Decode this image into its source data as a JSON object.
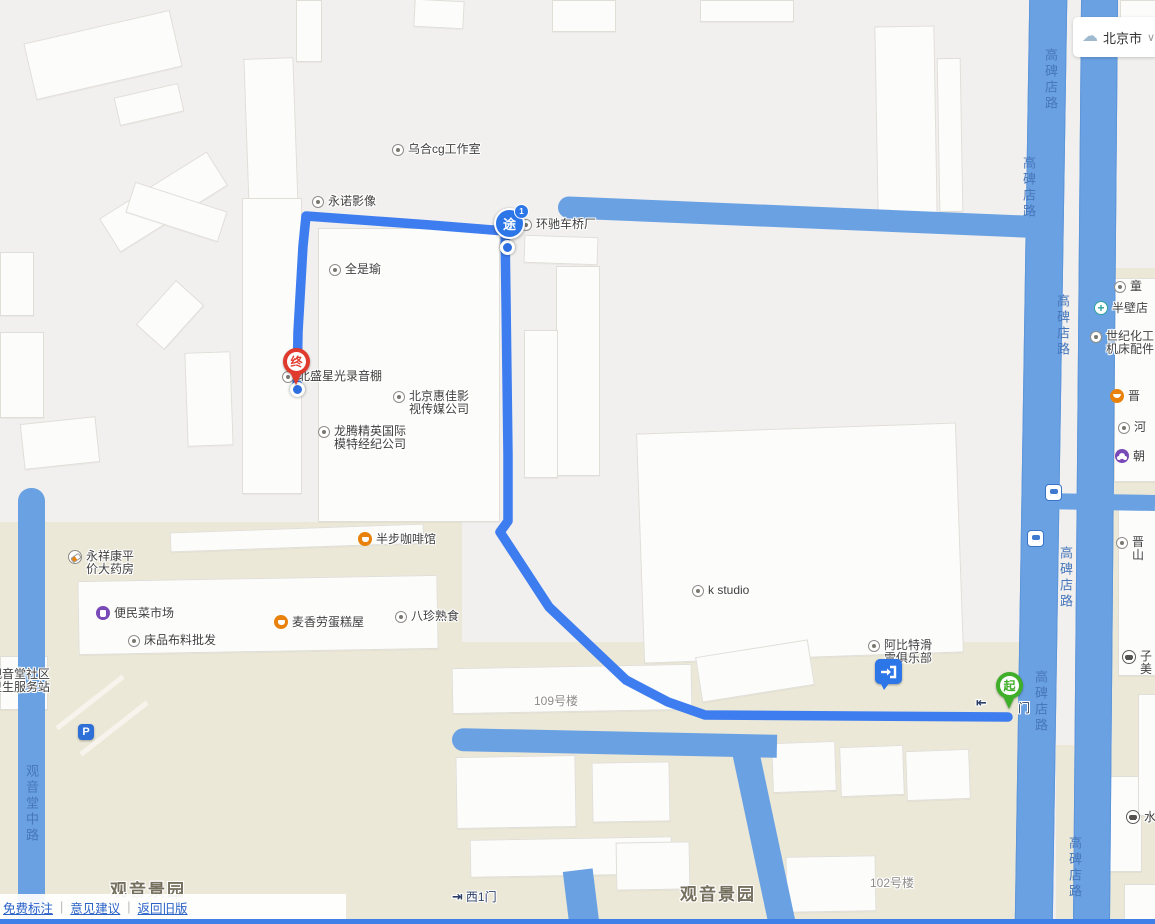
{
  "app": {
    "weather": {
      "city": "北京市",
      "icon": "cloud-rain-icon",
      "chevron": "∨"
    }
  },
  "footer": {
    "links": [
      "免费标注",
      "意见建议",
      "返回旧版"
    ],
    "separator": "|"
  },
  "route": {
    "start_label": "起",
    "via_label": "途",
    "via_badge": "1",
    "end_label": "终"
  },
  "roads": {
    "gaobeidian": "高碑店路",
    "guanyintang": "观音堂中路"
  },
  "areas": {
    "left": "观音景园",
    "center": "观音景园"
  },
  "building_labels": {
    "b109": "109号楼",
    "b102": "102号楼"
  },
  "gates": {
    "west": {
      "icon_char": "⇥",
      "text": "西1门"
    },
    "start": {
      "icon_char": "⇤",
      "text": "门"
    }
  },
  "pois": [
    {
      "text": "乌合cg工作室",
      "icon": "dot"
    },
    {
      "text": "永诺影像",
      "icon": "dot"
    },
    {
      "text": "环驰车桥厂",
      "icon": "dot"
    },
    {
      "text": "全是瑜",
      "icon": "dot"
    },
    {
      "text": "北盛星光录音棚",
      "icon": "dot"
    },
    {
      "lines": [
        "北京惠佳影",
        "视传媒公司"
      ],
      "icon": "dot"
    },
    {
      "lines": [
        "龙腾精英国际",
        "模特经纪公司"
      ],
      "icon": "dot"
    },
    {
      "text": "半步咖啡馆",
      "icon": "cafe"
    },
    {
      "lines": [
        "永祥康平",
        "价大药房"
      ],
      "icon": "pharmacy"
    },
    {
      "text": "便民菜市场",
      "icon": "market"
    },
    {
      "text": "麦香劳蛋糕屋",
      "icon": "cafe"
    },
    {
      "text": "床品布料批发",
      "icon": "dot"
    },
    {
      "text": "八珍熟食",
      "icon": "dot"
    },
    {
      "text": "k studio",
      "icon": "dot"
    },
    {
      "lines": [
        "阿比特滑",
        "雪俱乐部"
      ],
      "icon": "dot"
    },
    {
      "lines": [
        "观音堂社区",
        "卫生服务站"
      ],
      "icon": "none"
    },
    {
      "text": "童",
      "icon": "dot"
    },
    {
      "text": "半壁店",
      "icon": "hospital"
    },
    {
      "lines": [
        "世纪化工",
        "机床配件"
      ],
      "icon": "dot"
    },
    {
      "text": "晋",
      "icon": "bowl"
    },
    {
      "text": "河",
      "icon": "dot"
    },
    {
      "text": "朝",
      "icon": "grape"
    },
    {
      "lines": [
        "晋",
        "山"
      ],
      "icon": "dot"
    },
    {
      "lines": [
        "子",
        "美"
      ],
      "icon": "car"
    },
    {
      "text": "水",
      "icon": "car"
    }
  ],
  "parking_label": "P",
  "colors": {
    "route": "#3e7df0",
    "road": "#6aa1e3",
    "start_marker": "#3fae29",
    "end_marker": "#e03a2e",
    "via_marker": "#2d76e8",
    "area_beige": "#ebe8d7"
  }
}
